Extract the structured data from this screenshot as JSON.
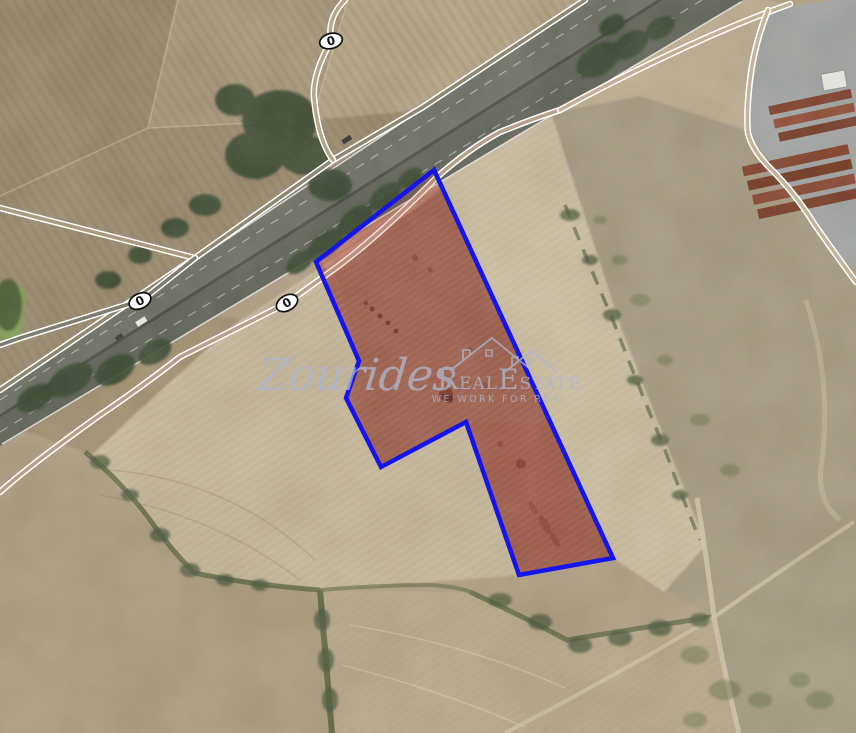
{
  "map": {
    "watermark": {
      "brand_script": "Zourides",
      "brand_serif_r": "R",
      "brand_serif_eal": "EAL",
      "brand_serif_e": "E",
      "brand_serif_state": "STATE",
      "tagline": "WE WORK FOR REAL",
      "color": "#aeb6ca"
    },
    "road_badges": [
      {
        "label": "0"
      },
      {
        "label": "0"
      },
      {
        "label": "0"
      }
    ],
    "parcel": {
      "outline_color": "#1414ee",
      "fill_tint": "rgba(201,60,45,0.16)"
    }
  }
}
